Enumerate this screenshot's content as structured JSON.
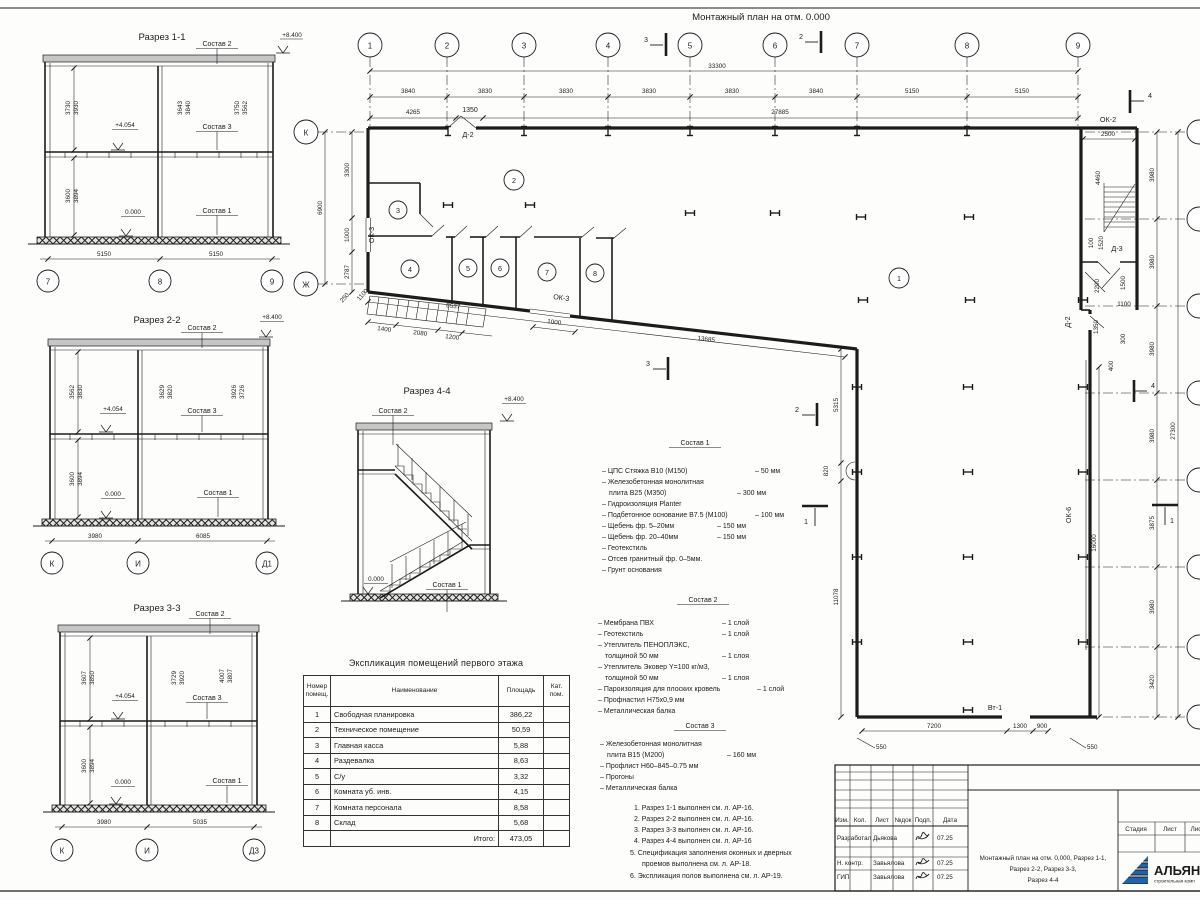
{
  "sheet": {
    "plan_title": "Монтажный план на отм. 0.000"
  },
  "plan": {
    "axes_top": [
      "1",
      "2",
      "3",
      "4",
      "5",
      "6",
      "7",
      "8",
      "9"
    ],
    "axes_left": [
      "К",
      "Ж"
    ],
    "dim_total": "33300",
    "dims_axes": [
      "3840",
      "3830",
      "3830",
      "3830",
      "3830",
      "3840",
      "5150",
      "5150"
    ],
    "dims_sub": [
      "4265",
      "1350",
      "27885"
    ],
    "dims_left": [
      "3300",
      "1000",
      "2787"
    ],
    "dim_left_total": "6900",
    "dims_corner": [
      "250",
      "1100"
    ],
    "ramp": {
      "dims": [
        "1400",
        "2080",
        "1200"
      ],
      "length": "8537",
      "window_dim": "1000",
      "diag_total": "13685"
    },
    "inner": [
      "5315",
      "820",
      "11078"
    ],
    "bottom": {
      "dims": [
        "7200",
        "1300",
        "900"
      ],
      "offsets": [
        "550",
        "550"
      ],
      "gate": "Вт-1"
    },
    "right": {
      "wall_dim": "16000",
      "chain": [
        "3980",
        "3980",
        "3980",
        "3980",
        "3875",
        "3980",
        "3420"
      ],
      "total": "27300",
      "stair": {
        "ok2": "ОК-2",
        "w": "2500",
        "h": "4460",
        "d3": "Д-3",
        "d3a": "1520",
        "d3b": "100",
        "v1": "2200",
        "v2": "1500",
        "v3": "1100",
        "d2": "Д-2",
        "e1": "1350",
        "e2": "300",
        "e3": "400"
      }
    },
    "labels": {
      "d2": "Д-2",
      "ok3l": "ОК-3",
      "ok3b": "ОК-3",
      "ok6": "ОК-6"
    },
    "rooms": [
      "1",
      "2",
      "3",
      "4",
      "5",
      "6",
      "7",
      "8"
    ],
    "marks": {
      "m1": "1",
      "m2": "2",
      "m3": "3",
      "m4": "4"
    }
  },
  "s1": {
    "title": "Разрез 1-1",
    "c2": "Состав 2",
    "c3": "Состав 3",
    "c1": "Состав 1",
    "e_top": "+8.400",
    "e_mid": "+4.054",
    "e_zero": "0.000",
    "p": [
      [
        "3730",
        "3930"
      ],
      [
        "3643",
        "3840"
      ],
      [
        "3750",
        "3562"
      ]
    ],
    "low": [
      "3600",
      "3894"
    ],
    "bot": [
      "5150",
      "5150"
    ],
    "axes": [
      "7",
      "8",
      "9"
    ]
  },
  "s2": {
    "title": "Разрез 2-2",
    "c2": "Состав 2",
    "c3": "Состав 3",
    "c1": "Состав 1",
    "e_top": "+8.400",
    "e_mid": "+4.054",
    "e_zero": "0.000",
    "p": [
      [
        "3562",
        "3830"
      ],
      [
        "3629",
        "3820"
      ],
      [
        "3926",
        "3726"
      ]
    ],
    "low": [
      "3600",
      "3894"
    ],
    "bot": [
      "3980",
      "6085"
    ],
    "axes": [
      "К",
      "И",
      "Д1"
    ]
  },
  "s3": {
    "title": "Разрез 3-3",
    "c2": "Состав 2",
    "c3": "Состав 3",
    "c1": "Состав 1",
    "e_mid": "+4.054",
    "e_zero": "0.000",
    "p": [
      [
        "3607",
        "3850"
      ],
      [
        "3729",
        "3920"
      ],
      [
        "4007",
        "3807"
      ]
    ],
    "low": [
      "3600",
      "3894"
    ],
    "bot": [
      "3980",
      "5035"
    ],
    "axes": [
      "К",
      "И",
      "Д3"
    ]
  },
  "s4": {
    "title": "Разрез 4-4",
    "c2": "Состав 2",
    "c1": "Состав 1",
    "e_top": "+8.400",
    "e_zero": "0.000"
  },
  "c1": {
    "title": "Состав 1",
    "items": [
      [
        "– ЦПС Стяжка В10 (М150)",
        "– 50 мм"
      ],
      [
        "– Железобетонная монолитная",
        ""
      ],
      [
        "плита В25 (М350)",
        "– 300 мм"
      ],
      [
        "– Гидроизоляция  Planter",
        ""
      ],
      [
        "– Подбетонное основание В7.5 (М100)",
        "– 100 мм"
      ],
      [
        "– Щебень фр. 5–20мм",
        "– 150 мм"
      ],
      [
        "– Щебень фр. 20–40мм",
        "– 150 мм"
      ],
      [
        "– Геотекстиль",
        ""
      ],
      [
        "– Отсев гранитный фр. 0–5мм.",
        ""
      ],
      [
        "– Грунт основания",
        ""
      ]
    ]
  },
  "c2": {
    "title": "Состав 2",
    "items": [
      [
        "– Мембрана ПВХ",
        "– 1 слой"
      ],
      [
        "– Геотекстиль",
        "– 1 слой"
      ],
      [
        "– Утеплитель ПЕНОПЛЭКС,",
        ""
      ],
      [
        "толщиной 50 мм",
        "– 1 слоя"
      ],
      [
        "– Утеплитель Эковер Y=100 кг/м3,",
        ""
      ],
      [
        "толщиной 50 мм",
        "– 1 слоя"
      ],
      [
        "– Пароизоляция для плоских кровель",
        "– 1 слой"
      ],
      [
        "– Профнастил Н75х0,9 мм",
        ""
      ],
      [
        "– Металлическая балка",
        ""
      ]
    ]
  },
  "c3": {
    "title": "Состав 3",
    "items": [
      [
        "– Железобетонная монолитная",
        ""
      ],
      [
        "плита В15 (М200)",
        "– 160 мм"
      ],
      [
        "– Профлист Н60–845–0.75 мм",
        ""
      ],
      [
        "– Прогоны",
        ""
      ],
      [
        "– Металлическая балка",
        ""
      ]
    ]
  },
  "notes": [
    "1. Разрез 1-1 выполнен см. л. АР-16.",
    "2. Разрез 2-2 выполнен см. л. АР-16.",
    "3. Разрез 3-3 выполнен см. л. АР-16.",
    "4. Разрез 4-4 выполнен см. л. АР-16",
    "5. Спецификация заполнения оконных и дверных",
    "проемов выполнена см. л. АР-18.",
    "6. Экспликация полов выполнена см. л. АР-19."
  ],
  "table": {
    "title": "Экспликация помещений первого этажа",
    "h": [
      "Номер помещ.",
      "Наименование",
      "Площадь",
      "Кат. пом."
    ],
    "rows": [
      [
        "1",
        "Свободная планировка",
        "386,22"
      ],
      [
        "2",
        "Техническое помещение",
        "50,59"
      ],
      [
        "3",
        "Главная касса",
        "5,88"
      ],
      [
        "4",
        "Раздевалка",
        "8,63"
      ],
      [
        "5",
        "С/у",
        "3,32"
      ],
      [
        "6",
        "Комната уб. инв.",
        "4,15"
      ],
      [
        "7",
        "Комната персонала",
        "8,58"
      ],
      [
        "8",
        "Склад",
        "5,68"
      ]
    ],
    "total_label": "Итого:",
    "total": "473,05"
  },
  "tb": {
    "cols": [
      "Изм.",
      "Кол.",
      "Лист",
      "№док",
      "Подп.",
      "Дата"
    ],
    "r1": {
      "role": "Разработал",
      "name": "Дьякова",
      "date": "07.25"
    },
    "r2": {
      "role": "Н. контр.",
      "name": "Завьялова",
      "date": "07.25"
    },
    "r3": {
      "role": "ГИП",
      "name": "Завьялова",
      "date": "07.25"
    },
    "doc": [
      "Монтажный план на отм. 0,000, Разрез 1-1,",
      "Разрез 2-2, Разрез 3-3,",
      "Разрез 4-4"
    ],
    "stage": [
      "Стадия",
      "Лист",
      "Лис"
    ],
    "logo": {
      "word": "АЛЬЯН",
      "sub": "строительная комп"
    }
  }
}
